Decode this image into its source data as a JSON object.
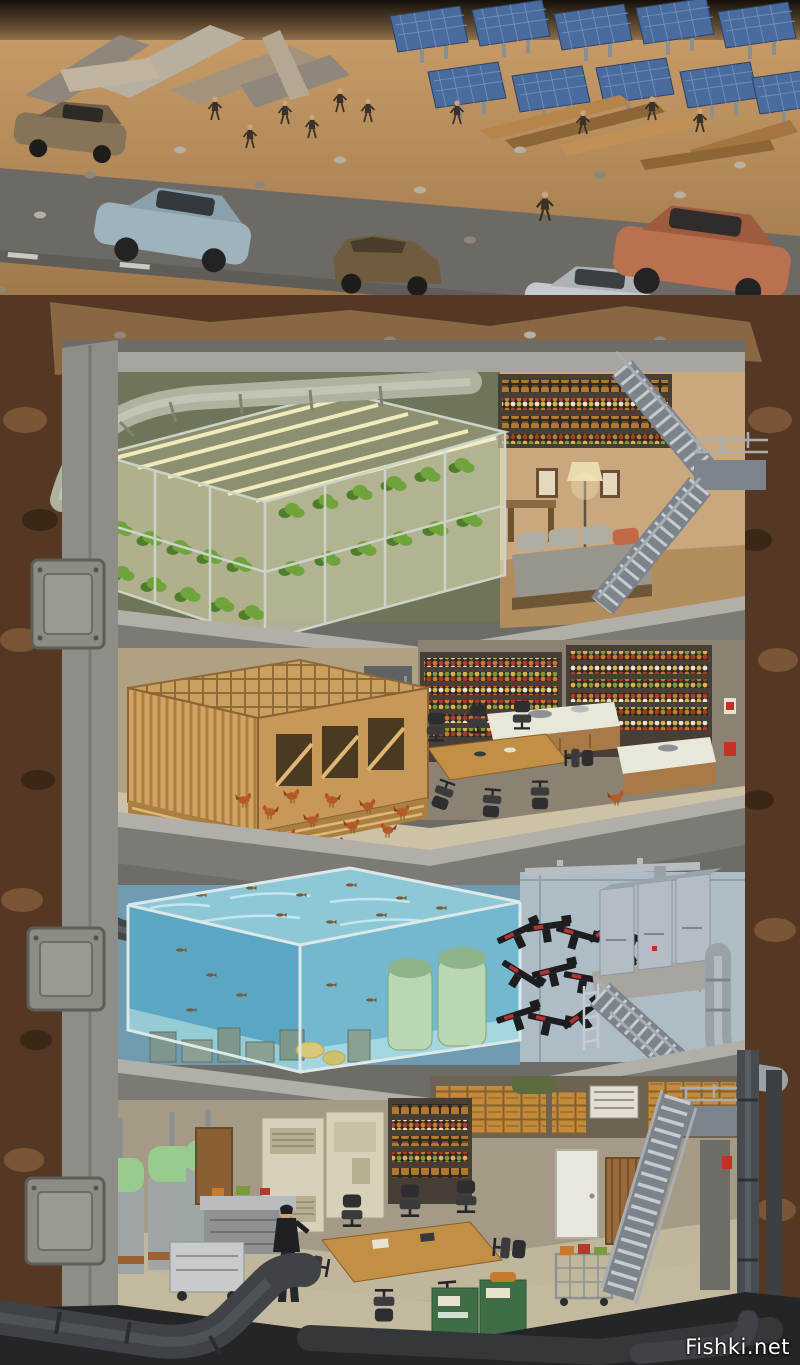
{
  "watermark": {
    "text": "Fishki.net",
    "color": "#ffffff"
  },
  "palette": {
    "sky-top": "#15100a",
    "sky-haze": "#d8b184",
    "ground": "#b3895b",
    "ground-dark": "#8f6a42",
    "road": "#6d6a66",
    "road-dark": "#585550",
    "panel-blue": "#4a6b9d",
    "rock": "#553823",
    "rock-light": "#7a5636",
    "rock-dark": "#3a2715",
    "concrete": "#8f8d88",
    "concrete-light": "#a8a5a0",
    "concrete-dark": "#6e6c67",
    "slab-front": "#7c7a74",
    "slab-top": "#b2afa9",
    "olive-wall": "#6f7558",
    "grow-glow": "#f4eec6",
    "plant": "#6fa33c",
    "plant-dark": "#4f7d2a",
    "lounge-wall": "#c9a87e",
    "lounge-floor": "#b18c5c",
    "sofa": "#98968c",
    "sofa-light": "#b0aea2",
    "pillow": "#c4684a",
    "steel": "#a7adb3",
    "steel-dark": "#7d838a",
    "coop-wood": "#cf9f5e",
    "coop-dark": "#a97f42",
    "coop-light": "#e0b876",
    "shelf-frame": "#473f36",
    "coop-floor": "#cdc2a6",
    "table-wood": "#c28f47",
    "chair": "#3b3b3e",
    "counter-wood": "#a87a48",
    "counter-top": "#e9e6da",
    "fridge": "#5f6264",
    "chicken": "#b55a25",
    "chicken-dark": "#8a3f1a",
    "water-top": "#8ec7d6",
    "water-front": "#5ba6c2",
    "water-side": "#74b8cf",
    "fish": "#7a5a35",
    "vessel-mint": "#b9d7b2",
    "vessel-mint-dark": "#8fb38a",
    "armory-wall": "#aebcc6",
    "armory-wall-dark": "#8fa0ac",
    "cabinet": "#b4bcc4",
    "cabinet-dark": "#9aa4ad",
    "gun": "#1d1d20",
    "gun-red": "#b4332e",
    "workshop-wall": "#a59a86",
    "workshop-floor": "#c3b99e",
    "beige-cabinet": "#d8d0b8",
    "green-cabinet": "#6d7a4a",
    "green-machine": "#3f6e46",
    "cylinder-green": "#98cc8f",
    "crate": "#c28a3a",
    "foundation": "#232526",
    "car-brown": "#857457",
    "car-bluegray": "#9fb3bd",
    "car-wreck": "#6f5b3d",
    "car-silver": "#c6c9cb",
    "car-copper": "#b9714f",
    "figure": "#3a3128",
    "watermark": "#ffffff"
  },
  "scene": {
    "surface": {
      "cars": [
        {
          "name": "brown-sedan",
          "color": "#857457"
        },
        {
          "name": "bluegray-sedan",
          "color": "#9fb3bd"
        },
        {
          "name": "wrecked-suv",
          "color": "#6f5b3d"
        },
        {
          "name": "silver-sedan",
          "color": "#c6c9cb"
        },
        {
          "name": "copper-suv",
          "color": "#b9714f"
        }
      ],
      "figure_count": 11,
      "solar_panel_count": 10
    },
    "floors": [
      {
        "name": "hydroponic-farm-and-lounge"
      },
      {
        "name": "chicken-coop-and-pantry"
      },
      {
        "name": "fish-tank-and-armory"
      },
      {
        "name": "workshop-and-storage"
      }
    ]
  }
}
